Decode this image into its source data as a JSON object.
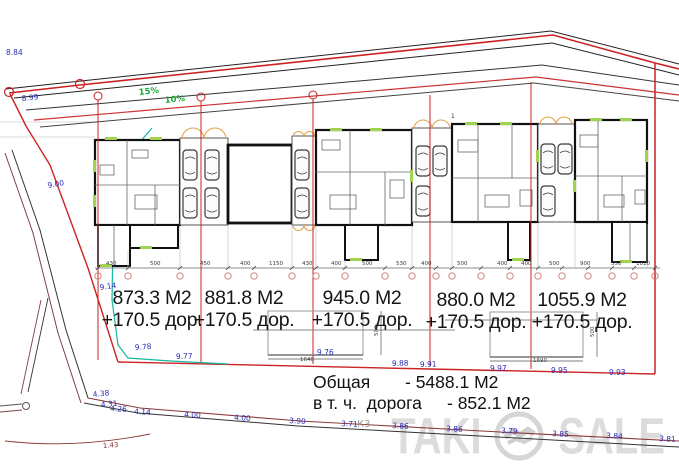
{
  "lots": [
    {
      "area": "873.3 М2",
      "road": "+170.5 дор."
    },
    {
      "area": "881.8 М2",
      "road": "+170.5 дор."
    },
    {
      "area": "945.0 М2",
      "road": "+170.5 дор."
    },
    {
      "area": "880.0 М2",
      "road": "+170.5 дор."
    },
    {
      "area": "1055.9 М2",
      "road": "+170.5 дор."
    }
  ],
  "summary": {
    "line1_label": "Общая",
    "line1_value": "- 5488.1 М2",
    "line2_label": "в т. ч.  дорога",
    "line2_value": "- 852.1 М2"
  },
  "watermark": {
    "left": "TAKI",
    "right": "SALE"
  },
  "colors": {
    "boundary_red": "#cc2222",
    "elevation_blue": "#2a2ab8",
    "slope_green": "#1fa93c",
    "road_dark_red": "#8b3a3a",
    "arc_orange": "#e2a24a",
    "watermark_gray": "#dcdcdc"
  },
  "annotations": [
    {
      "t": "8.84",
      "x": 6,
      "y": 55,
      "c": "blue"
    },
    {
      "t": "8.99",
      "x": 22,
      "y": 101,
      "c": "blue",
      "r": -6
    },
    {
      "t": "9.00",
      "x": 48,
      "y": 188,
      "c": "blue",
      "r": -10
    },
    {
      "t": "9.14",
      "x": 100,
      "y": 290,
      "c": "blue",
      "r": -8
    },
    {
      "t": "9.78",
      "x": 135,
      "y": 350,
      "c": "blue",
      "r": -4
    },
    {
      "t": "9.77",
      "x": 176,
      "y": 359,
      "c": "blue",
      "r": -2
    },
    {
      "t": "9.76",
      "x": 317,
      "y": 355,
      "c": "blue"
    },
    {
      "t": "9.88",
      "x": 392,
      "y": 366,
      "c": "blue",
      "r": -2
    },
    {
      "t": "9.91",
      "x": 420,
      "y": 367,
      "c": "blue",
      "r": -2
    },
    {
      "t": "9.97",
      "x": 490,
      "y": 371,
      "c": "blue"
    },
    {
      "t": "9.95",
      "x": 551,
      "y": 373,
      "c": "blue"
    },
    {
      "t": "9.93",
      "x": 609,
      "y": 375,
      "c": "blue"
    },
    {
      "t": "4.38",
      "x": 93,
      "y": 397,
      "c": "blue",
      "r": -6
    },
    {
      "t": "4.31",
      "x": 101,
      "y": 407,
      "c": "blue",
      "r": -4
    },
    {
      "t": "4.26",
      "x": 110,
      "y": 411,
      "c": "blue",
      "r": 3
    },
    {
      "t": "4.14",
      "x": 134,
      "y": 414,
      "c": "blue",
      "r": 3
    },
    {
      "t": "4.00",
      "x": 184,
      "y": 417,
      "c": "blue",
      "r": 3
    },
    {
      "t": "4.00",
      "x": 234,
      "y": 420,
      "c": "blue",
      "r": 3
    },
    {
      "t": "3.90",
      "x": 289,
      "y": 423,
      "c": "blue",
      "r": 3
    },
    {
      "t": "3.71",
      "x": 341,
      "y": 426,
      "c": "blue",
      "r": 3
    },
    {
      "t": "3.86",
      "x": 392,
      "y": 428,
      "c": "blue",
      "r": 3
    },
    {
      "t": "3.86",
      "x": 446,
      "y": 431,
      "c": "blue",
      "r": 3
    },
    {
      "t": "3.79",
      "x": 501,
      "y": 433,
      "c": "blue",
      "r": 3
    },
    {
      "t": "3.85",
      "x": 552,
      "y": 436,
      "c": "blue",
      "r": 3
    },
    {
      "t": "3.84",
      "x": 606,
      "y": 438,
      "c": "blue",
      "r": 3
    },
    {
      "t": "3.81",
      "x": 659,
      "y": 441,
      "c": "blue",
      "r": 3
    },
    {
      "t": "15%",
      "x": 139,
      "y": 95,
      "c": "green",
      "r": -6
    },
    {
      "t": "10%",
      "x": 165,
      "y": 103,
      "c": "green",
      "r": -6
    },
    {
      "t": "К3",
      "x": 357,
      "y": 427,
      "c": "hand"
    },
    {
      "t": "1.43",
      "x": 103,
      "y": 448,
      "c": "darkred",
      "r": -4
    },
    {
      "t": "1",
      "x": 451,
      "y": 118,
      "c": "tiny"
    },
    {
      "t": "430",
      "x": 106,
      "y": 265,
      "c": "dim"
    },
    {
      "t": "500",
      "x": 150,
      "y": 265,
      "c": "dim"
    },
    {
      "t": "450",
      "x": 200,
      "y": 265,
      "c": "dim"
    },
    {
      "t": "400",
      "x": 240,
      "y": 265,
      "c": "dim"
    },
    {
      "t": "1150",
      "x": 269,
      "y": 265,
      "c": "dim"
    },
    {
      "t": "430",
      "x": 302,
      "y": 265,
      "c": "dim"
    },
    {
      "t": "400",
      "x": 331,
      "y": 265,
      "c": "dim"
    },
    {
      "t": "500",
      "x": 362,
      "y": 265,
      "c": "dim"
    },
    {
      "t": "530",
      "x": 396,
      "y": 265,
      "c": "dim"
    },
    {
      "t": "400",
      "x": 421,
      "y": 265,
      "c": "dim"
    },
    {
      "t": "500",
      "x": 457,
      "y": 265,
      "c": "dim"
    },
    {
      "t": "400",
      "x": 497,
      "y": 265,
      "c": "dim"
    },
    {
      "t": "400",
      "x": 521,
      "y": 265,
      "c": "dim"
    },
    {
      "t": "500",
      "x": 549,
      "y": 265,
      "c": "dim"
    },
    {
      "t": "900",
      "x": 580,
      "y": 265,
      "c": "dim"
    },
    {
      "t": "550",
      "x": 611,
      "y": 265,
      "c": "dim"
    },
    {
      "t": "1010",
      "x": 636,
      "y": 265,
      "c": "dim"
    },
    {
      "t": "500",
      "x": 378,
      "y": 336,
      "c": "dim",
      "r": -90
    },
    {
      "t": "500",
      "x": 594,
      "y": 337,
      "c": "dim",
      "r": -90
    },
    {
      "t": "1640",
      "x": 300,
      "y": 361,
      "c": "dim"
    },
    {
      "t": "1690",
      "x": 533,
      "y": 362,
      "c": "dim"
    }
  ]
}
